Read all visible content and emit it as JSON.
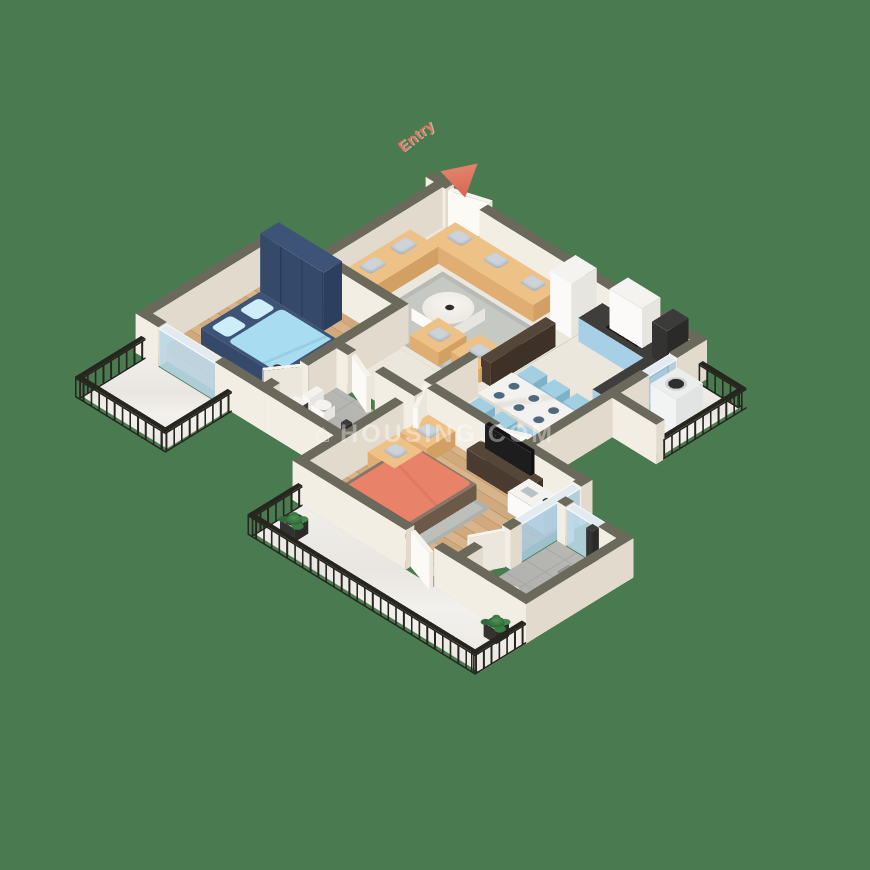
{
  "palette": {
    "background": "#4a7a50",
    "wallTop": "#6a695b",
    "wallFace": "#f3eee4",
    "woodFloor": "#d8b48a",
    "tileFloor": "#b7b7b3",
    "creamFloor": "#ece7dd",
    "kitchenBlue": "#a7cfe6",
    "diningChairBlue": "#a2cfe2",
    "bedBlue": "#a8dcf0",
    "bedCoral": "#e8836a",
    "sofaTan": "#eec287",
    "wardrobeNavy": "#3d5377",
    "railing": "#26261f",
    "plantGreen": "#3a7d42",
    "entry": "#dd7260",
    "watermark": "rgba(255,255,255,0.38)"
  },
  "entry": {
    "label": "Entry"
  },
  "watermark": {
    "text": "HOUSING.COM",
    "icon": "house-icon"
  }
}
